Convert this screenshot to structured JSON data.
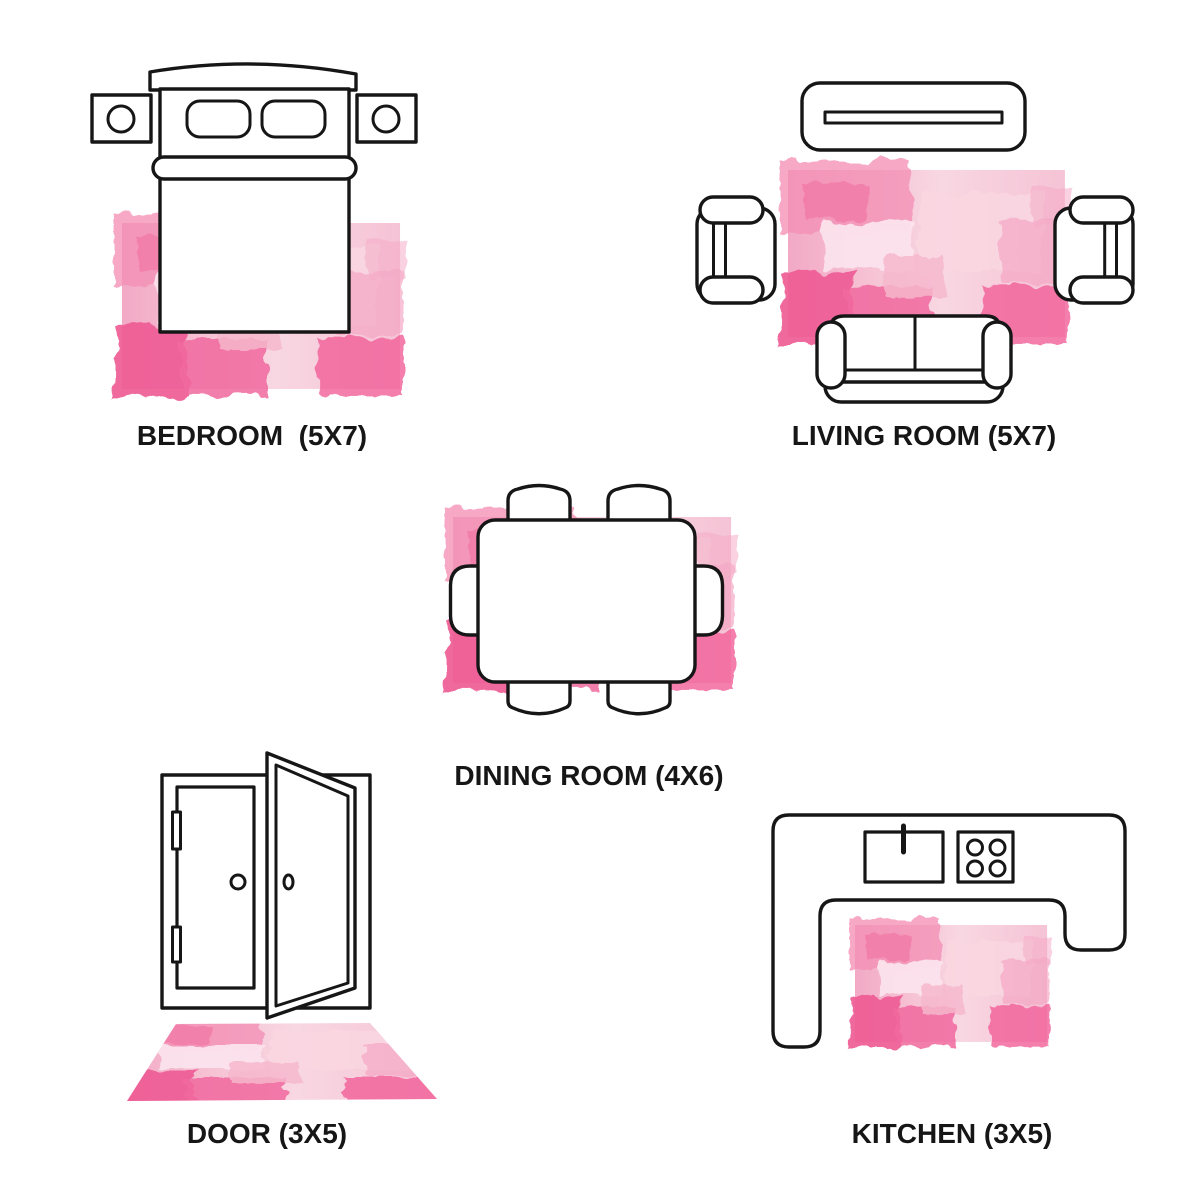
{
  "page": {
    "background_color": "#ffffff",
    "outline_color": "#161616"
  },
  "rug_palette": {
    "base_wash": "#f6c3d4",
    "pale_pink": "#fbe3ec",
    "medium_pink": "#f390b5",
    "hot_pink": "#ee5c95",
    "accent_pink": "#f0699e"
  },
  "rooms": [
    {
      "id": "bedroom",
      "label": "BEDROOM  (5X7)",
      "rug_size": "5X7"
    },
    {
      "id": "living-room",
      "label": "LIVING ROOM (5X7)",
      "rug_size": "5X7"
    },
    {
      "id": "dining-room",
      "label": "DINING ROOM (4X6)",
      "rug_size": "4X6"
    },
    {
      "id": "door",
      "label": "DOOR (3X5)",
      "rug_size": "3X5"
    },
    {
      "id": "kitchen",
      "label": "KITCHEN (3X5)",
      "rug_size": "3X5"
    }
  ]
}
